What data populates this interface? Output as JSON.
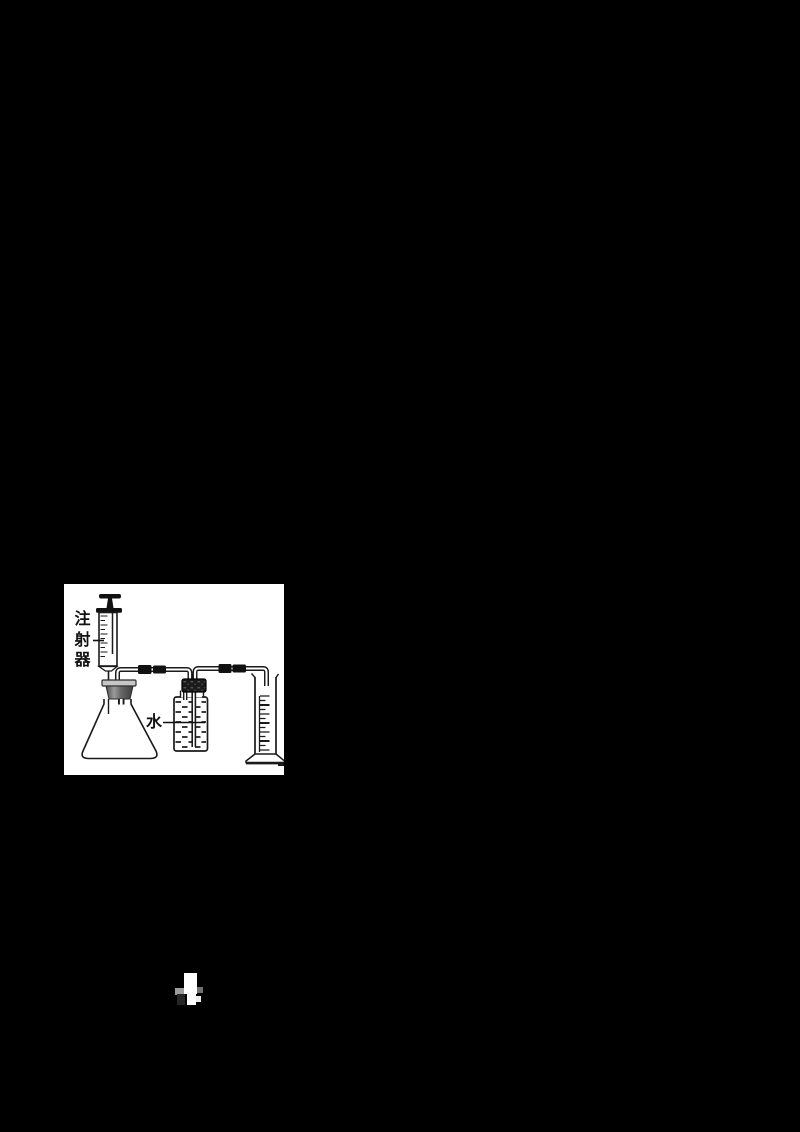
{
  "page": {
    "background_color": "#000000"
  },
  "figure": {
    "background_color": "#ffffff",
    "ink_color": "#1a1a1a",
    "labels": {
      "syringe": "注射器",
      "water": "水"
    }
  }
}
